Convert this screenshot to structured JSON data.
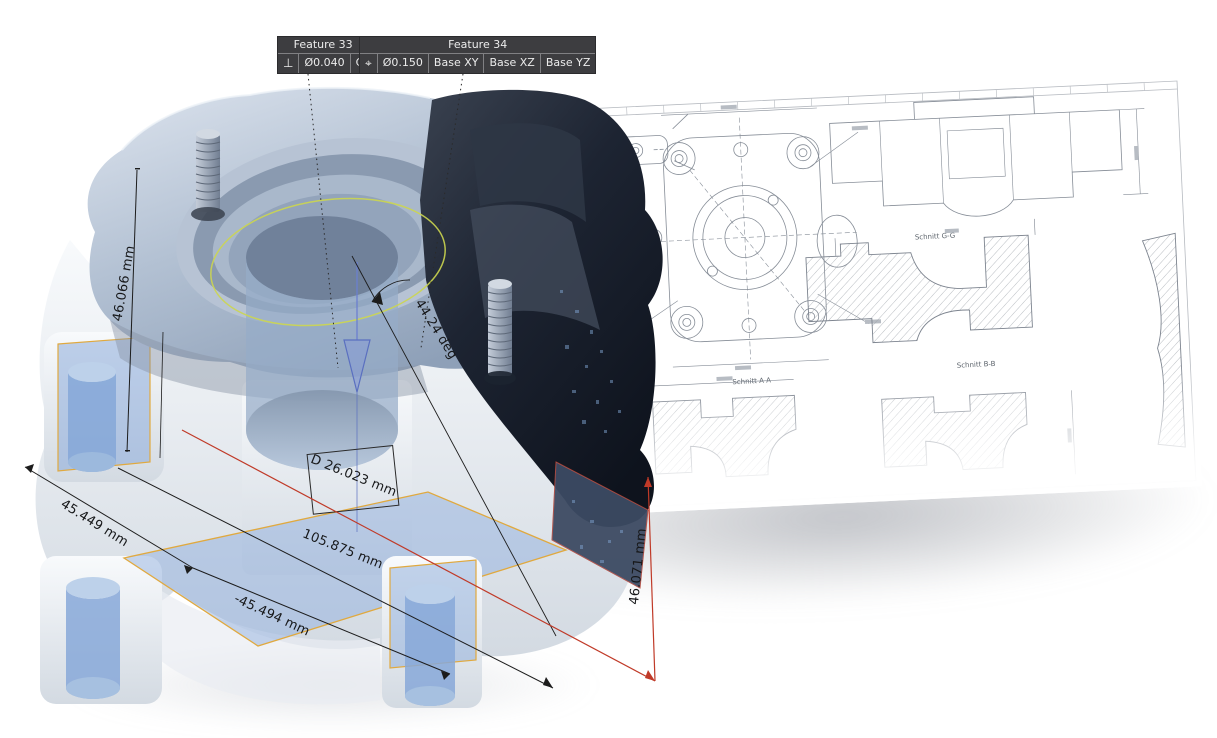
{
  "viewport": {
    "name": "3D inspection view of measured housing part"
  },
  "callouts": {
    "feature33": {
      "title": "Feature 33",
      "symbol": "⊥",
      "tolerance": "Ø0.040",
      "datum": "C"
    },
    "feature34": {
      "title": "Feature 34",
      "symbol": "⌖",
      "tolerance": "Ø0.150",
      "datum_1": "Base XY",
      "datum_2": "Base XZ",
      "datum_3": "Base YZ"
    }
  },
  "dimensions": {
    "height_left": "46.066 mm",
    "front_width": "45.449 mm",
    "diagonal_length": "105.875 mm",
    "back_width": "-45.494 mm",
    "bore_diameter": "D 26.023 mm",
    "cone_angle": "44.24 deg",
    "height_right": "46.071 mm"
  },
  "drawing": {
    "section_a": "Schnitt A-A",
    "section_g": "Schnitt G-G",
    "section_b": "Schnitt B-B"
  },
  "colors": {
    "dimension_line": "#1c1c1c",
    "highlight_red": "#c03a28",
    "highlight_orange": "#e0a93f",
    "measured_circle_yellow": "#ccd64f",
    "callout_background": "#3d3d40",
    "callout_text": "#ececec",
    "transparent_blue": "#8fb2dc",
    "dark_section": "#1b2230"
  }
}
